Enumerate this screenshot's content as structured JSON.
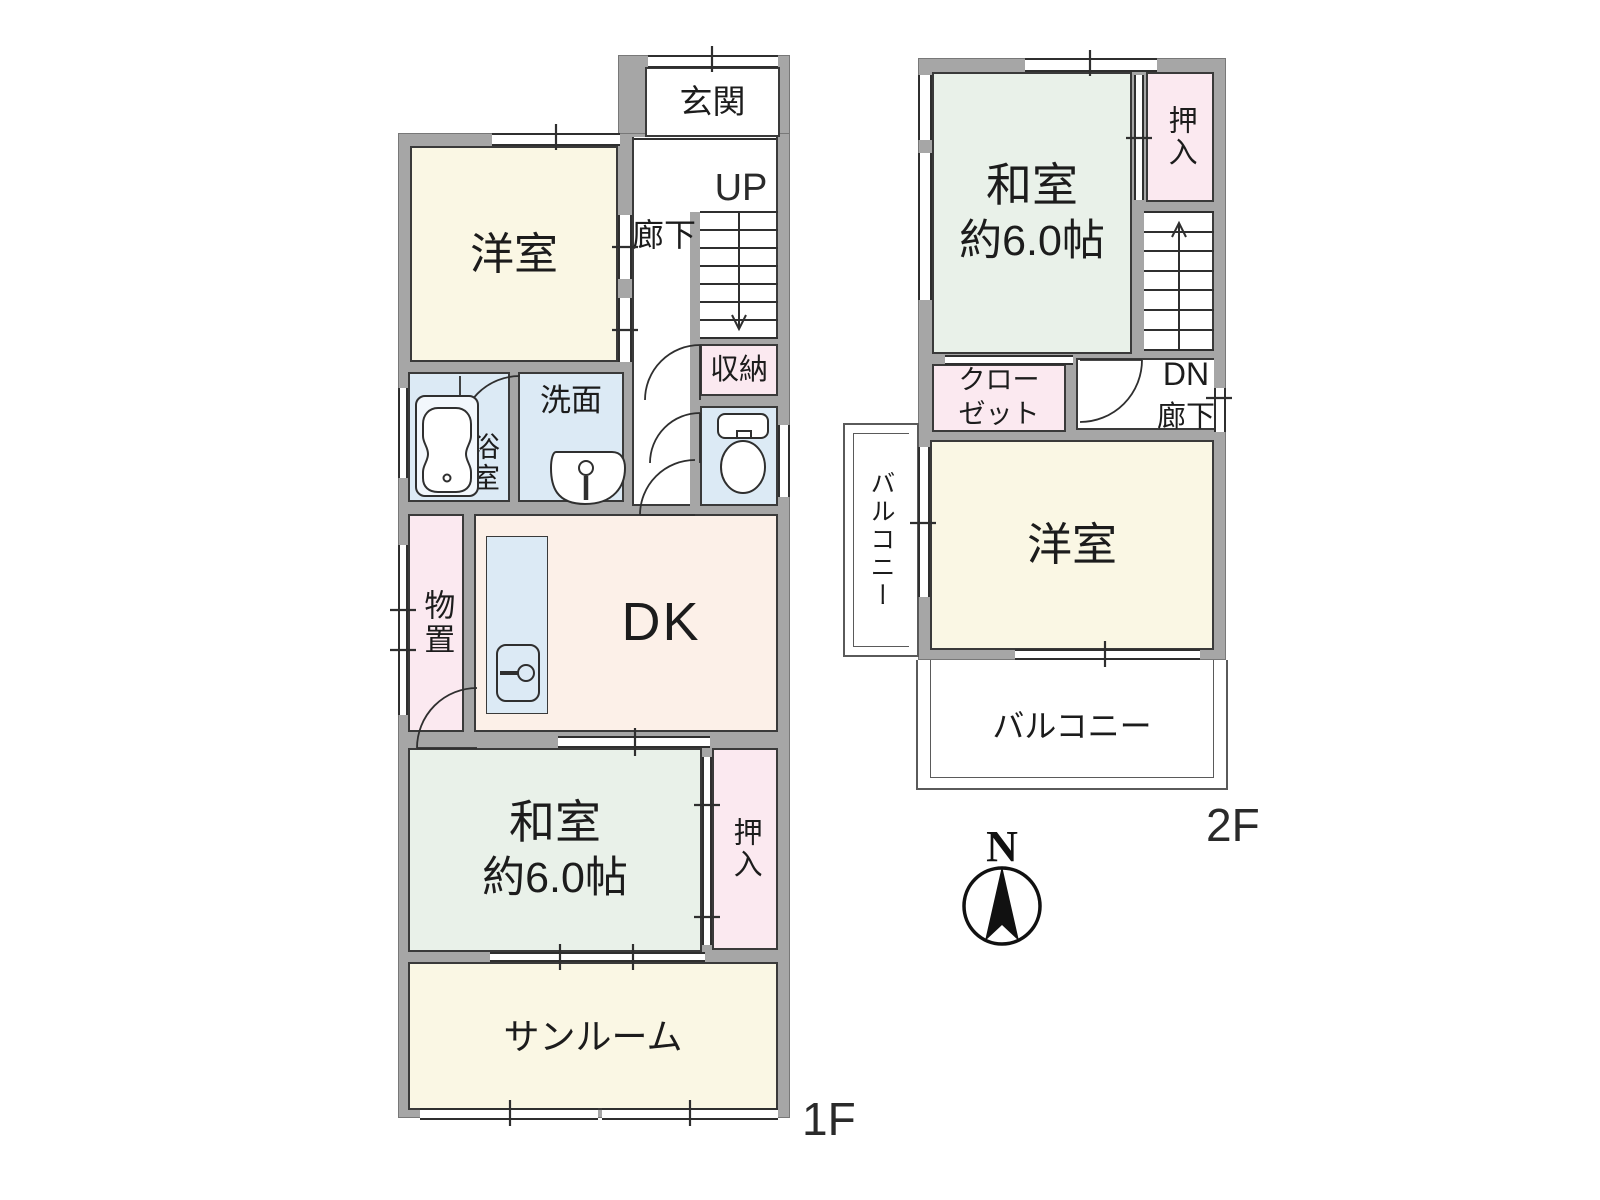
{
  "floor1": {
    "floor_label": "1F",
    "genkan": "玄関",
    "hallway": "廊下",
    "stairs_up": "UP",
    "shunou": "収納",
    "youshitsu": "洋室",
    "yokushitsu": "浴室",
    "senmen": "洗面",
    "monooki": "物置",
    "dk": "DK",
    "washitsu_name": "和室",
    "washitsu_size": "約6.0帖",
    "oshiire": "押入",
    "sunroom": "サンルーム"
  },
  "floor2": {
    "floor_label": "2F",
    "washitsu_name": "和室",
    "washitsu_size": "約6.0帖",
    "oshiire": "押入",
    "stairs_down": "DN",
    "hallway": "廊下",
    "closet_line1": "クロー",
    "closet_line2": "ゼット",
    "youshitsu": "洋室",
    "balcony_left": "バルコニー",
    "balcony_bottom": "バルコニー"
  },
  "compass": {
    "north_label": "N"
  },
  "colors": {
    "wall": "#a6a6a6",
    "line": "#3a3a3a",
    "room_cream": "#faf7e4",
    "room_green": "#e9f1e9",
    "room_pink": "#fbe9f0",
    "room_blue": "#dceaf5",
    "room_peach": "#fcf0e8"
  }
}
